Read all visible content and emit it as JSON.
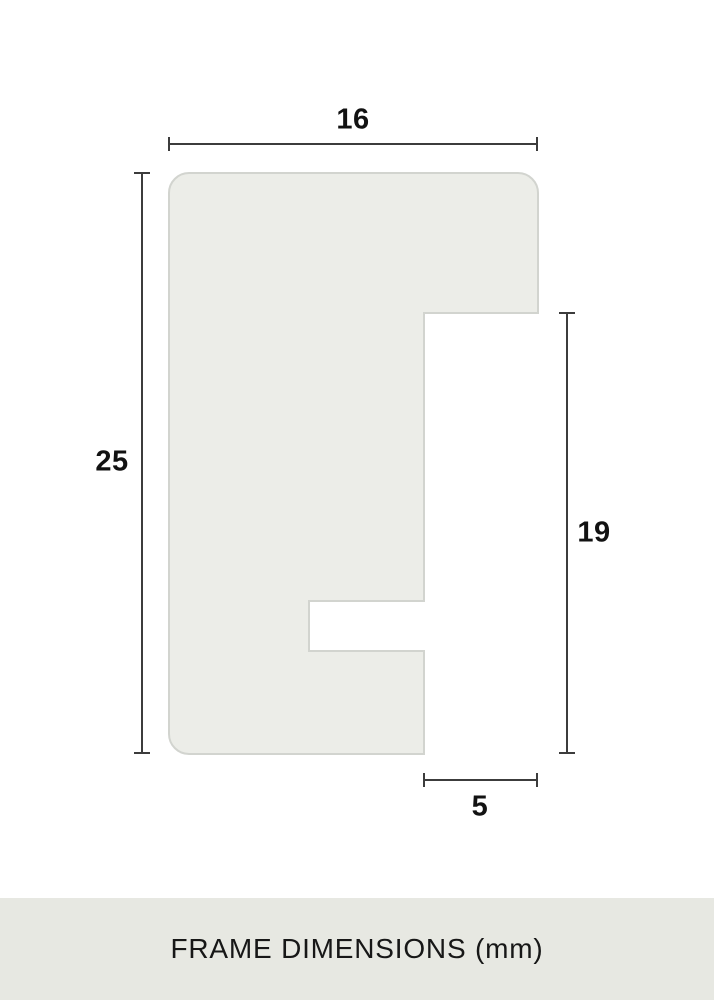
{
  "diagram": {
    "type": "frame-profile-cross-section",
    "dimensions": {
      "top_width": "16",
      "left_height": "25",
      "right_height": "19",
      "bottom_rabbet_width": "5"
    },
    "colors": {
      "shape_fill": "#ECEDE8",
      "shape_border": "#D2D4CF",
      "dimension_line": "#3C3C3C",
      "label_text": "#121212",
      "footer_background": "#E7E8E2",
      "footer_text": "#171717",
      "page_background": "#FFFFFF"
    }
  },
  "footer": {
    "label": "FRAME DIMENSIONS (mm)"
  }
}
